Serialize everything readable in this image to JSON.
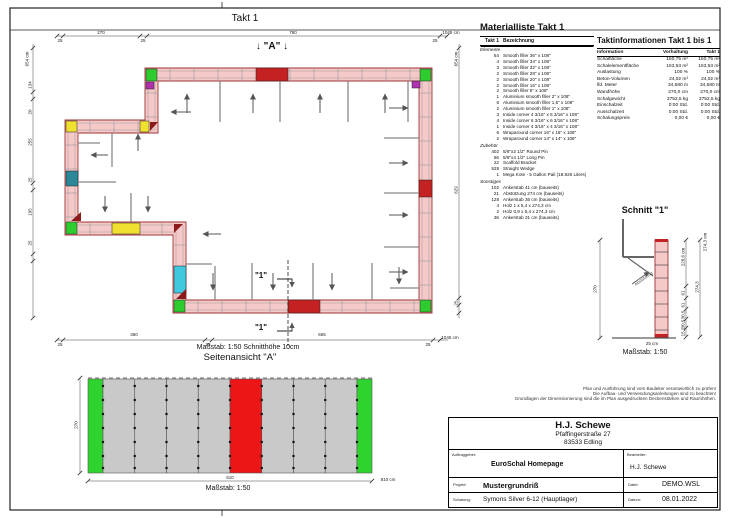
{
  "sheet": {
    "band_title": "Takt 1"
  },
  "plan": {
    "marker_a": "↓ \"A\" ↓",
    "cut_marker": "\"1\"",
    "scale_caption": "Maßstab: 1:50   Schnitthöhe 10cm",
    "dims_top": [
      "25",
      "270",
      "25",
      "780",
      "25"
    ],
    "dims_top_total": "1045 cm",
    "dims_bottom": [
      "25",
      "360",
      "25",
      "665",
      "25"
    ],
    "dims_bottom_total": "1045 cm",
    "dims_left": [
      "134",
      "20",
      "255",
      "25",
      "195",
      "25"
    ],
    "dims_left_total": "654 cm",
    "dims_right": [
      "629",
      "25"
    ],
    "dims_right_total": "654 cm"
  },
  "elevation": {
    "title": "Seitenansicht \"A\"",
    "scale": "Maßstab: 1:50",
    "dim_height": "270",
    "dim_width": "810",
    "dim_width_total": "810 cm"
  },
  "schnitt": {
    "title": "Schnitt \"1\"",
    "scale": "Maßstab: 1:50",
    "brace_label": "Abstützung",
    "dim_height": "270",
    "dim_total": "274,3 cm",
    "dim_total2": "274,3",
    "dims": [
      "228,6 cm",
      "61",
      "61",
      "30,5",
      "30,5",
      "15,2"
    ],
    "note": "25 cm"
  },
  "materials": {
    "title": "Materialliste  Takt 1",
    "col_qty": "Takt 1",
    "col_name": "Bezeichnung",
    "sections": [
      {
        "name": "Elemente",
        "items": [
          {
            "qty": "54",
            "name": "Smooth filler 36\" x 108\""
          },
          {
            "qty": "4",
            "name": "Smooth filler 34\" x 108\""
          },
          {
            "qty": "3",
            "name": "Smooth filler 32\" x 108\""
          },
          {
            "qty": "2",
            "name": "Smooth filler 28\" x 108\""
          },
          {
            "qty": "2",
            "name": "Smooth filler 20\" x 108\""
          },
          {
            "qty": "2",
            "name": "Smooth filler 16\" x 108\""
          },
          {
            "qty": "2",
            "name": "Smooth filler 6\" x 108\""
          },
          {
            "qty": "1",
            "name": "Aluminium smooth filler 2\" x 108\""
          },
          {
            "qty": "6",
            "name": "Aluminium smooth filler 1,5\" x 108\""
          },
          {
            "qty": "2",
            "name": "Aluminium smooth filler 1\" x 108\""
          },
          {
            "qty": "3",
            "name": "Inside corner 4 3/16\" x 6 3/16\" x 108\""
          },
          {
            "qty": "4",
            "name": "Inside corner 6 3/16\" x 6 3/16\" x 108\""
          },
          {
            "qty": "1",
            "name": "Inside corner 4 3/16\" x 4 3/16\" x 108\""
          },
          {
            "qty": "6",
            "name": "Wraparound corner 16\" x 16\" x 108\""
          },
          {
            "qty": "2",
            "name": "Wraparound corner 14\" x 14\" x 108\""
          }
        ]
      },
      {
        "name": "Zubehör",
        "items": [
          {
            "qty": "402",
            "name": "5/8\"x2 1/2\" Round Pin"
          },
          {
            "qty": "66",
            "name": "5/8\"x4 1/2\" Long Pin"
          },
          {
            "qty": "22",
            "name": "Scaffold Bracket"
          },
          {
            "qty": "528",
            "name": "Straight Wedge"
          },
          {
            "qty": "1",
            "name": "Mega Kote - 5 Gallon Pail (18.926 Liters)"
          }
        ]
      },
      {
        "name": "Sonstiges",
        "items": [
          {
            "qty": "102",
            "name": "Ankerstab 41 cm (bauseits)"
          },
          {
            "qty": "21",
            "name": "Abstützung 274 cm (bauseits)"
          },
          {
            "qty": "128",
            "name": "Ankerstab 36 cm (bauseits)"
          },
          {
            "qty": "4",
            "name": "Holz 1 x 5,4 x 274,3 cm"
          },
          {
            "qty": "2",
            "name": "Holz 0,9 x 5,4 x 274,3 cm"
          },
          {
            "qty": "36",
            "name": "Ankerstab 31 cm (bauseits)"
          }
        ]
      }
    ]
  },
  "taktinfo": {
    "title": "Taktinformationen  Takt 1 bis 1",
    "columns": [
      "Information",
      "Vorhaltung",
      "Takt 1"
    ],
    "rows": [
      [
        "Schalfläche",
        "160,75 m²",
        "160,75 m²"
      ],
      [
        "Schalelementfläche",
        "163,53 m²",
        "163,53 m²"
      ],
      [
        "Auslastung",
        "100 %",
        "100 %"
      ],
      [
        "Beton-Volumen",
        "24,02 m³",
        "24,02 m³"
      ],
      [
        "lfd. Meter",
        "34,580 m",
        "34,580 m"
      ],
      [
        "Wandhöhe",
        "270,0 cm",
        "270,0 cm"
      ],
      [
        "Schalgewicht",
        "3752,5 kg",
        "3752,5 kg"
      ],
      [
        "Einschalzeit",
        "0:00 Std.",
        "0:00 Std."
      ],
      [
        "Ausschalzeit",
        "0:00 Std.",
        "0:00 Std."
      ],
      [
        "Schalungspreis",
        "0,00 €",
        "0,00 €"
      ]
    ]
  },
  "disclaimer": [
    "Plan und Ausführung sind vom Bauleiter verantwortlich zu prüfen!",
    "Die Aufbau- und Verwendungsanleitungen sind zu beachten!",
    "Grundlagen der Dimensionierung sind die im Plan ausgedruckten Deckenstärken und Raumhöhen."
  ],
  "titleblock": {
    "company": "H.J. Schewe",
    "street": "Pfaffingerstraße 27",
    "city": "83533 Edling",
    "auftraggeber_label": "Auftraggeber:",
    "auftraggeber": "EuroSchal Homepage",
    "bearbeiter_label": "Bearbeiter:",
    "bearbeiter": "H.J. Schewe",
    "projekt_label": "Projekt:",
    "projekt": "Mustergrundriß",
    "datei_label": "Datei:",
    "datei": "DEMO.WSL",
    "schalung_label": "Schalung:",
    "schalung": "Symons Silver 6-12 (Hauptlager)",
    "datum_label": "Datum:",
    "datum": "08.01.2022"
  },
  "colors": {
    "wall_fill": "#f6c9c9",
    "wall_stroke": "#a03333",
    "panel_green": "#2ecc2e",
    "panel_yellow": "#f0e030",
    "panel_purple": "#b030b0",
    "panel_cyan": "#40c8e0",
    "panel_teal": "#2a8898",
    "filler_red": "#c42222",
    "elev_gray": "#c9c9c9",
    "elev_red": "#ec1616",
    "elev_green": "#2ed32e"
  }
}
